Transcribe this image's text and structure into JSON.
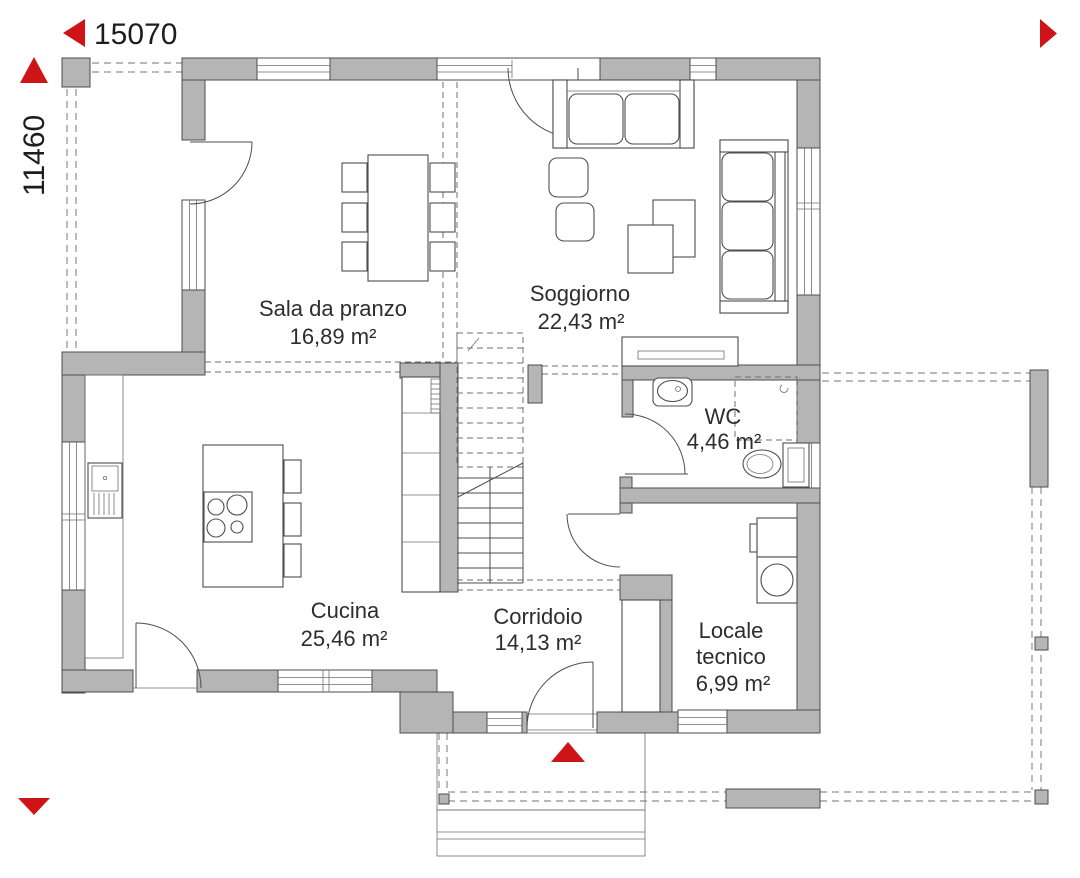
{
  "plan": {
    "dimensions": {
      "width_label": "15070",
      "height_label": "11460"
    },
    "rooms": {
      "sala_da_pranzo": {
        "name": "Sala da pranzo",
        "area": "16,89 m²"
      },
      "soggiorno": {
        "name": "Soggiorno",
        "area": "22,43 m²"
      },
      "wc": {
        "name": "WC",
        "area": "4,46 m²"
      },
      "cucina": {
        "name": "Cucina",
        "area": "25,46 m²"
      },
      "corridoio": {
        "name": "Corridoio",
        "area": "14,13 m²"
      },
      "locale_tecnico": {
        "name_line1": "Locale",
        "name_line2": "tecnico",
        "area": "6,99 m²"
      }
    },
    "icons": {
      "dimension_arrow_left": "left-triangle",
      "dimension_arrow_up": "up-triangle",
      "dimension_arrow_right": "right-triangle",
      "dimension_arrow_down": "down-triangle",
      "entrance_arrow": "up-triangle"
    },
    "colors": {
      "wall": "#b5b5b5",
      "accent_red": "#cf1418",
      "line": "#4d4d4d",
      "text": "#2d2d2d"
    }
  }
}
